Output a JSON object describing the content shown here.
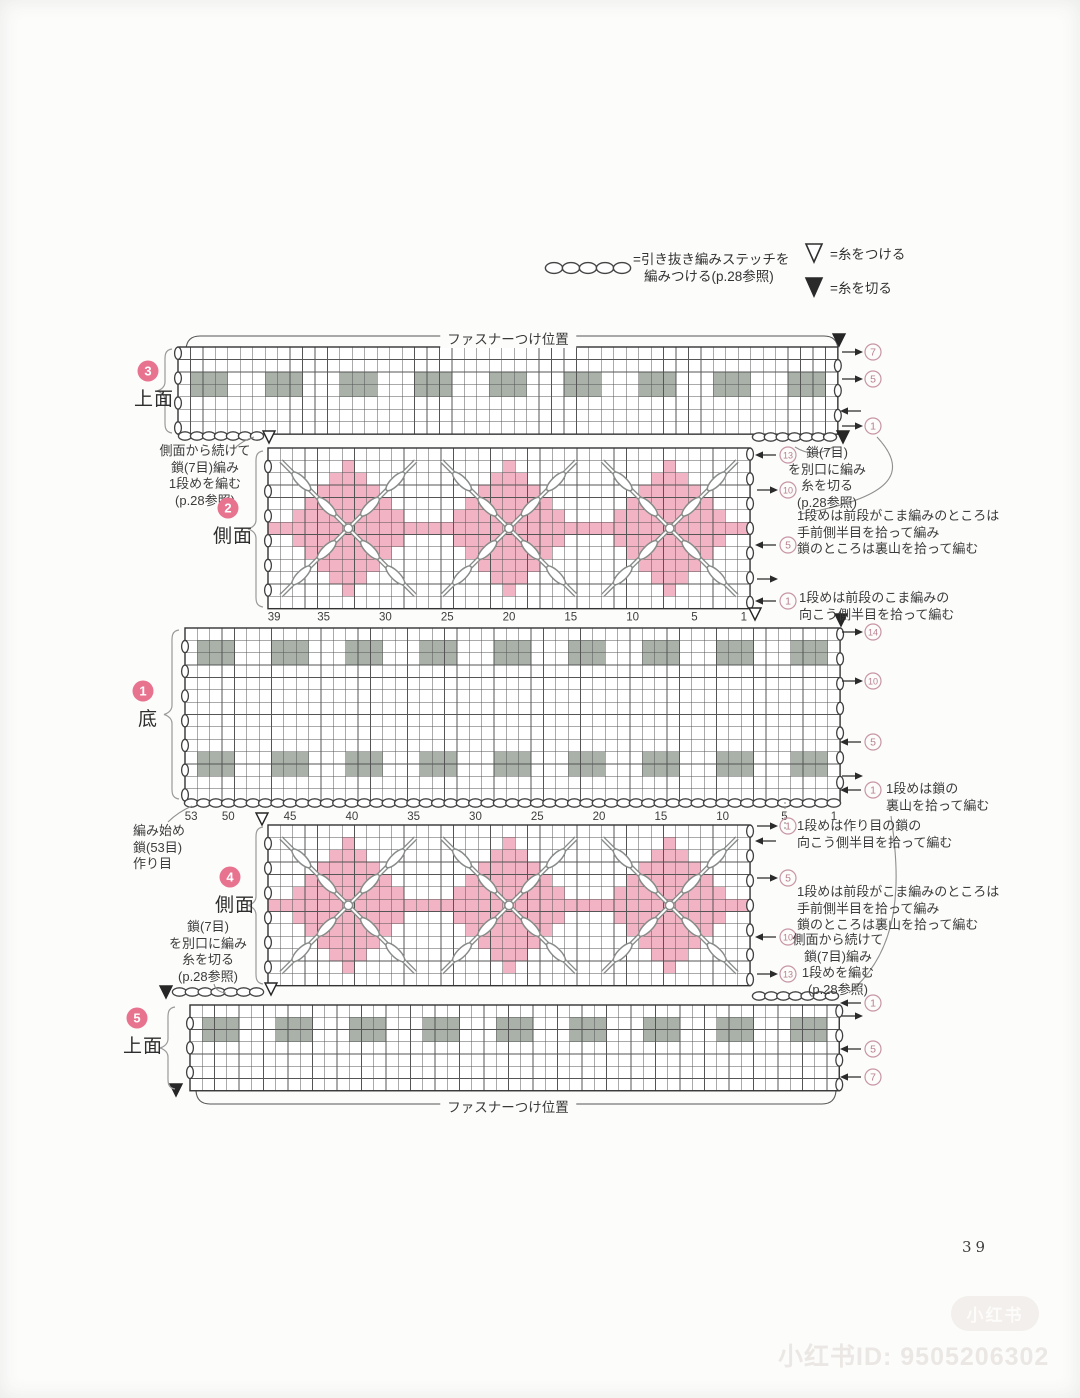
{
  "page": {
    "number": "39"
  },
  "colors": {
    "pink": "#f2b4c4",
    "gray_block": "#a9b1a9",
    "grid_line": "#555555",
    "stitch": "#888c89",
    "mark_pink": "#c795a5",
    "mark_text_pink": "#b97f91",
    "badge_pink": "#e8738f"
  },
  "legend": {
    "chain_line1": "=引き抜き編みステッチを",
    "chain_line2": "編みつける(p.28参照)",
    "attach_label": "=糸をつける",
    "cut_label": "=糸を切る"
  },
  "zipper": {
    "top_label": "ファスナーつけ位置",
    "bottom_label": "ファスナーつけ位置"
  },
  "watermark": {
    "badge": "小红书",
    "id_line": "小红书ID: 9505206302"
  },
  "sections": [
    {
      "num": "3",
      "name": "上面",
      "badge_x": 148,
      "badge_y": 371,
      "name_x": 134,
      "name_y": 384
    },
    {
      "num": "2",
      "name": "側面",
      "badge_x": 228,
      "badge_y": 508,
      "name_x": 213,
      "name_y": 521
    },
    {
      "num": "1",
      "name": "底",
      "badge_x": 143,
      "badge_y": 691,
      "name_x": 138,
      "name_y": 704
    },
    {
      "num": "4",
      "name": "側面",
      "badge_x": 230,
      "badge_y": 877,
      "name_x": 215,
      "name_y": 890
    },
    {
      "num": "5",
      "name": "上面",
      "badge_x": 137,
      "badge_y": 1018,
      "name_x": 123,
      "name_y": 1031
    }
  ],
  "annotations": [
    {
      "name": "side-continue-note-top",
      "x": 205,
      "y": 443,
      "align": "center",
      "lines": [
        "側面から続けて",
        "鎖(7目)編み",
        "1段めを編む",
        "(p.28参照)"
      ]
    },
    {
      "name": "chain-separate-note-right",
      "x": 827,
      "y": 445,
      "align": "center",
      "lines": [
        "鎖(7目)",
        "を別口に編み",
        "糸を切る",
        "(p.28参照)"
      ]
    },
    {
      "name": "row1-pickup-note-side-upper",
      "x": 797,
      "y": 508,
      "align": "left",
      "lines": [
        "1段めは前段がこま編みのところは",
        "手前側半目を拾って編み",
        "鎖のところは裏山を拾って編む"
      ]
    },
    {
      "name": "row1-pickup-note-upper-bottom",
      "x": 799,
      "y": 590,
      "align": "left",
      "lines": [
        "1段めは前段のこま編みの",
        "向こう側半目を拾って編む"
      ]
    },
    {
      "name": "start-note",
      "x": 133,
      "y": 823,
      "align": "left",
      "lines": [
        "編み始め",
        "鎖(53目)",
        "作り目"
      ]
    },
    {
      "name": "row1-chain-note-bottom",
      "x": 886,
      "y": 781,
      "align": "left",
      "lines": [
        "1段めは鎖の",
        "裏山を拾って編む"
      ]
    },
    {
      "name": "row1-foundation-note",
      "x": 797,
      "y": 818,
      "align": "left",
      "lines": [
        "1段めは作り目の鎖の",
        "向こう側半目を拾って編む"
      ]
    },
    {
      "name": "row1-pickup-note-side-lower",
      "x": 797,
      "y": 884,
      "align": "left",
      "lines": [
        "1段めは前段がこま編みのところは",
        "手前側半目を拾って編み",
        "鎖のところは裏山を拾って編む"
      ]
    },
    {
      "name": "chain-separate-note-left",
      "x": 208,
      "y": 919,
      "align": "center",
      "lines": [
        "鎖(7目)",
        "を別口に編み",
        "糸を切る",
        "(p.28参照)"
      ]
    },
    {
      "name": "side-continue-note-bottom",
      "x": 838,
      "y": 932,
      "align": "center",
      "lines": [
        "側面から続けて",
        "鎖(7目)編み",
        "1段めを編む",
        "(p.28参照)"
      ]
    }
  ],
  "diagram": {
    "grids": [
      {
        "sec": "3",
        "x": 178,
        "y": 347,
        "cols": 53,
        "rows": 7,
        "cell": 12.45,
        "gray_band_rows": [
          3
        ],
        "left_ovals": [
          1,
          3,
          5,
          7
        ],
        "right_ovals": [
          2,
          4,
          6
        ]
      },
      {
        "sec": "2",
        "x": 268,
        "y": 448,
        "cols": 39,
        "rows": 13,
        "cell": 12.36,
        "diamond_cols": [
          7,
          20,
          33
        ],
        "diamond_row": 7,
        "left_ovals": [
          2,
          4,
          6,
          8,
          10,
          12
        ],
        "right_ovals": [
          1,
          3,
          5,
          7,
          9,
          11,
          13
        ],
        "col_numbers": [
          39,
          35,
          30,
          25,
          20,
          15,
          10,
          5,
          1
        ],
        "num_dy": 12
      },
      {
        "sec": "1",
        "x": 185,
        "y": 628,
        "cols": 53,
        "rows": 14,
        "cell": 12.36,
        "gray_band_rows": [
          2,
          11
        ],
        "left_ovals": [
          2,
          4,
          6,
          8,
          10,
          12,
          14
        ],
        "right_ovals": [
          1,
          3,
          5,
          7,
          9,
          11,
          13
        ],
        "col_numbers": [
          53,
          50,
          45,
          40,
          35,
          30,
          25,
          20,
          15,
          10,
          5,
          1
        ],
        "num_dy": 19
      },
      {
        "sec": "4",
        "x": 268,
        "y": 825,
        "cols": 39,
        "rows": 13,
        "cell": 12.36,
        "diamond_cols": [
          7,
          20,
          33
        ],
        "diamond_row": 7,
        "left_ovals": [
          2,
          4,
          6,
          8,
          10,
          12
        ],
        "right_ovals": [
          1,
          3,
          5,
          7,
          9,
          11,
          13
        ]
      },
      {
        "sec": "5",
        "x": 190,
        "y": 1005,
        "cols": 53,
        "rows": 7,
        "cell": 12.25,
        "gray_band_rows": [
          2
        ],
        "left_ovals": [
          2,
          4,
          6
        ],
        "right_ovals": [
          1,
          3,
          5,
          7
        ]
      }
    ],
    "gray_block": {
      "start_col": 2,
      "width": 3,
      "height": 2,
      "repeat": 6
    },
    "chains": [
      {
        "x1": 179,
        "x2": 263,
        "y": 436,
        "n": 7
      },
      {
        "x1": 753,
        "x2": 836,
        "y": 437,
        "n": 7
      },
      {
        "x1": 185,
        "x2": 840,
        "y": 803,
        "n": 53
      },
      {
        "x1": 173,
        "x2": 263,
        "y": 992,
        "n": 7
      },
      {
        "x1": 753,
        "x2": 838,
        "y": 996,
        "n": 7
      }
    ],
    "triangles": [
      {
        "x": 839,
        "y": 340,
        "filled": true
      },
      {
        "x": 843,
        "y": 437,
        "filled": true
      },
      {
        "x": 269,
        "y": 437,
        "filled": false
      },
      {
        "x": 755,
        "y": 614,
        "filled": false
      },
      {
        "x": 841,
        "y": 620,
        "filled": true
      },
      {
        "x": 262,
        "y": 819,
        "filled": false
      },
      {
        "x": 166,
        "y": 992,
        "filled": true
      },
      {
        "x": 271,
        "y": 989,
        "filled": false
      },
      {
        "x": 176,
        "y": 1090,
        "filled": true
      }
    ],
    "braces": [
      {
        "x": 164,
        "y1": 349,
        "y2": 433
      },
      {
        "x": 255,
        "y1": 451,
        "y2": 607
      },
      {
        "x": 171,
        "y1": 630,
        "y2": 799
      },
      {
        "x": 255,
        "y1": 827,
        "y2": 984
      },
      {
        "x": 167,
        "y1": 1007,
        "y2": 1089
      }
    ],
    "marks": [
      {
        "x": 842,
        "y": 352,
        "dir": "right",
        "n": "7"
      },
      {
        "x": 842,
        "y": 379,
        "dir": "right",
        "n": "5"
      },
      {
        "x": 842,
        "y": 411,
        "dir": "left"
      },
      {
        "x": 842,
        "y": 426,
        "dir": "right",
        "n": "1"
      },
      {
        "x": 757,
        "y": 455,
        "dir": "left",
        "n": "13"
      },
      {
        "x": 757,
        "y": 490,
        "dir": "right",
        "n": "10"
      },
      {
        "x": 757,
        "y": 545,
        "dir": "left",
        "n": "5"
      },
      {
        "x": 757,
        "y": 579,
        "dir": "right"
      },
      {
        "x": 757,
        "y": 601,
        "dir": "left",
        "n": "1"
      },
      {
        "x": 842,
        "y": 632,
        "dir": "right",
        "n": "14"
      },
      {
        "x": 842,
        "y": 681,
        "dir": "right",
        "n": "10"
      },
      {
        "x": 842,
        "y": 742,
        "dir": "left",
        "n": "5"
      },
      {
        "x": 842,
        "y": 776,
        "dir": "right"
      },
      {
        "x": 842,
        "y": 790,
        "dir": "left",
        "n": "1"
      },
      {
        "x": 757,
        "y": 826,
        "dir": "right",
        "n": "1"
      },
      {
        "x": 757,
        "y": 841,
        "dir": "left"
      },
      {
        "x": 757,
        "y": 878,
        "dir": "right",
        "n": "5"
      },
      {
        "x": 757,
        "y": 937,
        "dir": "left",
        "n": "10"
      },
      {
        "x": 757,
        "y": 974,
        "dir": "right",
        "n": "13"
      },
      {
        "x": 842,
        "y": 1003,
        "dir": "left",
        "n": "1"
      },
      {
        "x": 842,
        "y": 1016,
        "dir": "right"
      },
      {
        "x": 842,
        "y": 1049,
        "dir": "left",
        "n": "5"
      },
      {
        "x": 842,
        "y": 1077,
        "dir": "left",
        "n": "7"
      }
    ]
  }
}
